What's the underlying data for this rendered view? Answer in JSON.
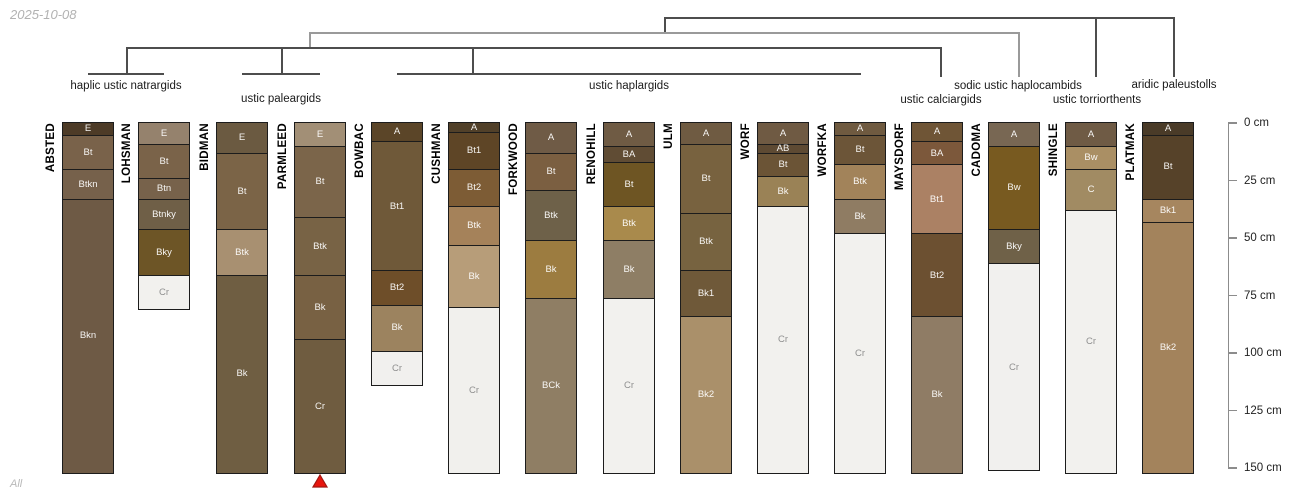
{
  "page": {
    "date_label": "2025-10-08",
    "footer_label": "All"
  },
  "chart_data": {
    "type": "bar",
    "subtype": "soil-profile-sketches-with-taxonomy-dendrogram",
    "title": "",
    "depth_axis": {
      "unit": "cm",
      "ticks": [
        0,
        25,
        50,
        75,
        100,
        125,
        150
      ],
      "tick_labels": [
        "0 cm",
        "25 cm",
        "50 cm",
        "75 cm",
        "100 cm",
        "125 cm",
        "150 cm"
      ],
      "range": [
        0,
        152
      ],
      "position": "right"
    },
    "taxa": [
      {
        "label": "haplic ustic natrargids",
        "members": [
          "ABSTED",
          "LOHSMAN"
        ],
        "x": 126,
        "y": 86
      },
      {
        "label": "ustic paleargids",
        "members": [
          "BIDMAN",
          "PARMLEED"
        ],
        "x": 281,
        "y": 99
      },
      {
        "label": "ustic haplargids",
        "members": [
          "BOWBAC",
          "CUSHMAN",
          "FORKWOOD",
          "RENOHILL",
          "ULM",
          "WORF",
          "WORFKA"
        ],
        "x": 629,
        "y": 86
      },
      {
        "label": "ustic calciargids",
        "members": [
          "MAYSDORF"
        ],
        "x": 941,
        "y": 100
      },
      {
        "label": "sodic ustic haplocambids",
        "members": [
          "CADOMA"
        ],
        "x": 1018,
        "y": 86
      },
      {
        "label": "ustic torriorthents",
        "members": [
          "SHINGLE"
        ],
        "x": 1097,
        "y": 100
      },
      {
        "label": "aridic paleustolls",
        "members": [
          "PLATMAK"
        ],
        "x": 1174,
        "y": 85
      }
    ],
    "dendrogram": {
      "levels": [
        {
          "y": 18,
          "x1": 665,
          "x2": 1174,
          "shade": "dark",
          "drops": [
            [
              665,
              33
            ],
            [
              1096,
              77
            ],
            [
              1174,
              77
            ]
          ]
        },
        {
          "y": 33,
          "x1": 310,
          "x2": 1019,
          "shade": "gray",
          "drops": [
            [
              310,
              48
            ],
            [
              1019,
              77
            ]
          ]
        },
        {
          "y": 48,
          "x1": 127,
          "x2": 941,
          "shade": "dark",
          "drops": [
            [
              127,
              74
            ],
            [
              282,
              74
            ],
            [
              473,
              74
            ],
            [
              941,
              77
            ]
          ]
        }
      ],
      "brackets": [
        [
          88,
          164,
          74
        ],
        [
          242,
          320,
          74
        ],
        [
          397,
          861,
          74
        ]
      ]
    },
    "profiles": [
      {
        "name": "ABSTED",
        "horizons": [
          {
            "name": "E",
            "top": 0,
            "bottom": 5,
            "color": "#4d3b27"
          },
          {
            "name": "Bt",
            "top": 5,
            "bottom": 20,
            "color": "#79624a"
          },
          {
            "name": "Btkn",
            "top": 20,
            "bottom": 33,
            "color": "#76614b"
          },
          {
            "name": "Bkn",
            "top": 33,
            "bottom": 152,
            "color": "#6e5a45"
          }
        ]
      },
      {
        "name": "LOHSMAN",
        "horizons": [
          {
            "name": "E",
            "top": 0,
            "bottom": 9,
            "color": "#95826d"
          },
          {
            "name": "Bt",
            "top": 9,
            "bottom": 24,
            "color": "#7a6349"
          },
          {
            "name": "Btn",
            "top": 24,
            "bottom": 33,
            "color": "#77624b"
          },
          {
            "name": "Btnky",
            "top": 33,
            "bottom": 46,
            "color": "#6f5f47"
          },
          {
            "name": "Bky",
            "top": 46,
            "bottom": 66,
            "color": "#6d5526"
          },
          {
            "name": "Cr",
            "top": 66,
            "bottom": 81,
            "color": "#f2f1ee"
          }
        ]
      },
      {
        "name": "BIDMAN",
        "horizons": [
          {
            "name": "E",
            "top": 0,
            "bottom": 13,
            "color": "#6b5a41"
          },
          {
            "name": "Bt",
            "top": 13,
            "bottom": 46,
            "color": "#7b6447"
          },
          {
            "name": "Btk",
            "top": 46,
            "bottom": 66,
            "color": "#a89071"
          },
          {
            "name": "Bk",
            "top": 66,
            "bottom": 152,
            "color": "#6f5e42"
          }
        ]
      },
      {
        "name": "PARMLEED",
        "horizons": [
          {
            "name": "E",
            "top": 0,
            "bottom": 10,
            "color": "#a28f76"
          },
          {
            "name": "Bt",
            "top": 10,
            "bottom": 41,
            "color": "#7b654a"
          },
          {
            "name": "Btk",
            "top": 41,
            "bottom": 66,
            "color": "#786345"
          },
          {
            "name": "Bk",
            "top": 66,
            "bottom": 94,
            "color": "#786143"
          },
          {
            "name": "Cr",
            "top": 94,
            "bottom": 152,
            "color": "#6f5c40"
          }
        ]
      },
      {
        "name": "BOWBAC",
        "horizons": [
          {
            "name": "A",
            "top": 0,
            "bottom": 8,
            "color": "#5b4528"
          },
          {
            "name": "Bt1",
            "top": 8,
            "bottom": 64,
            "color": "#6f5939"
          },
          {
            "name": "Bt2",
            "top": 64,
            "bottom": 79,
            "color": "#6e4e29"
          },
          {
            "name": "Bk",
            "top": 79,
            "bottom": 99,
            "color": "#9c835f"
          },
          {
            "name": "Cr",
            "top": 99,
            "bottom": 114,
            "color": "#f1f0ee"
          }
        ]
      },
      {
        "name": "CUSHMAN",
        "horizons": [
          {
            "name": "A",
            "top": 0,
            "bottom": 4,
            "color": "#514029"
          },
          {
            "name": "Bt1",
            "top": 4,
            "bottom": 20,
            "color": "#5e4526"
          },
          {
            "name": "Bt2",
            "top": 20,
            "bottom": 36,
            "color": "#7d5c35"
          },
          {
            "name": "Btk",
            "top": 36,
            "bottom": 53,
            "color": "#a5825a"
          },
          {
            "name": "Bk",
            "top": 53,
            "bottom": 80,
            "color": "#b79d79"
          },
          {
            "name": "Cr",
            "top": 80,
            "bottom": 152,
            "color": "#f1f0ed"
          }
        ]
      },
      {
        "name": "FORKWOOD",
        "horizons": [
          {
            "name": "A",
            "top": 0,
            "bottom": 13,
            "color": "#6f5b46"
          },
          {
            "name": "Bt",
            "top": 13,
            "bottom": 29,
            "color": "#7b5f41"
          },
          {
            "name": "Btk",
            "top": 29,
            "bottom": 51,
            "color": "#6e6149"
          },
          {
            "name": "Bk",
            "top": 51,
            "bottom": 76,
            "color": "#9c7c40"
          },
          {
            "name": "BCk",
            "top": 76,
            "bottom": 152,
            "color": "#8f7e64"
          }
        ]
      },
      {
        "name": "RENOHILL",
        "horizons": [
          {
            "name": "A",
            "top": 0,
            "bottom": 10,
            "color": "#6f5b44"
          },
          {
            "name": "BA",
            "top": 10,
            "bottom": 17,
            "color": "#604c34"
          },
          {
            "name": "Bt",
            "top": 17,
            "bottom": 36,
            "color": "#6e5523"
          },
          {
            "name": "Btk",
            "top": 36,
            "bottom": 51,
            "color": "#a98a4c"
          },
          {
            "name": "Bk",
            "top": 51,
            "bottom": 76,
            "color": "#8e7e65"
          },
          {
            "name": "Cr",
            "top": 76,
            "bottom": 152,
            "color": "#f2f1ee"
          }
        ]
      },
      {
        "name": "ULM",
        "horizons": [
          {
            "name": "A",
            "top": 0,
            "bottom": 9,
            "color": "#6f5b42"
          },
          {
            "name": "Bt",
            "top": 9,
            "bottom": 39,
            "color": "#78623f"
          },
          {
            "name": "Btk",
            "top": 39,
            "bottom": 64,
            "color": "#776340"
          },
          {
            "name": "Bk1",
            "top": 64,
            "bottom": 84,
            "color": "#6f5939"
          },
          {
            "name": "Bk2",
            "top": 84,
            "bottom": 152,
            "color": "#aa906a"
          }
        ]
      },
      {
        "name": "WORF",
        "horizons": [
          {
            "name": "A",
            "top": 0,
            "bottom": 9,
            "color": "#6f5a43"
          },
          {
            "name": "AB",
            "top": 9,
            "bottom": 13,
            "color": "#5e4a33"
          },
          {
            "name": "Bt",
            "top": 13,
            "bottom": 23,
            "color": "#6b5436"
          },
          {
            "name": "Bk",
            "top": 23,
            "bottom": 36,
            "color": "#9a8256"
          },
          {
            "name": "Cr",
            "top": 36,
            "bottom": 152,
            "color": "#f2f1ee"
          }
        ]
      },
      {
        "name": "WORFKA",
        "horizons": [
          {
            "name": "A",
            "top": 0,
            "bottom": 5,
            "color": "#6f5a40"
          },
          {
            "name": "Bt",
            "top": 5,
            "bottom": 18,
            "color": "#6c5538"
          },
          {
            "name": "Btk",
            "top": 18,
            "bottom": 33,
            "color": "#a2835a"
          },
          {
            "name": "Bk",
            "top": 33,
            "bottom": 48,
            "color": "#8f7c63"
          },
          {
            "name": "Cr",
            "top": 48,
            "bottom": 152,
            "color": "#f2f1ee"
          }
        ]
      },
      {
        "name": "MAYSDORF",
        "horizons": [
          {
            "name": "A",
            "top": 0,
            "bottom": 8,
            "color": "#6f5536"
          },
          {
            "name": "BA",
            "top": 8,
            "bottom": 18,
            "color": "#7c583b"
          },
          {
            "name": "Bt1",
            "top": 18,
            "bottom": 48,
            "color": "#ab8164"
          },
          {
            "name": "Bt2",
            "top": 48,
            "bottom": 84,
            "color": "#6c5031"
          },
          {
            "name": "Bk",
            "top": 84,
            "bottom": 152,
            "color": "#8f7c65"
          }
        ]
      },
      {
        "name": "CADOMA",
        "horizons": [
          {
            "name": "A",
            "top": 0,
            "bottom": 10,
            "color": "#786753"
          },
          {
            "name": "Bw",
            "top": 10,
            "bottom": 46,
            "color": "#785a20"
          },
          {
            "name": "Bky",
            "top": 46,
            "bottom": 61,
            "color": "#6f6148"
          },
          {
            "name": "Cr",
            "top": 61,
            "bottom": 151,
            "color": "#f1f0ee"
          }
        ]
      },
      {
        "name": "SHINGLE",
        "horizons": [
          {
            "name": "A",
            "top": 0,
            "bottom": 10,
            "color": "#6f5b45"
          },
          {
            "name": "Bw",
            "top": 10,
            "bottom": 20,
            "color": "#aa8f64"
          },
          {
            "name": "C",
            "top": 20,
            "bottom": 38,
            "color": "#a18b63"
          },
          {
            "name": "Cr",
            "top": 38,
            "bottom": 152,
            "color": "#f2f1ee"
          }
        ]
      },
      {
        "name": "PLATMAK",
        "horizons": [
          {
            "name": "A",
            "top": 0,
            "bottom": 5,
            "color": "#4a3b28"
          },
          {
            "name": "Bt",
            "top": 5,
            "bottom": 33,
            "color": "#564229"
          },
          {
            "name": "Bk1",
            "top": 33,
            "bottom": 43,
            "color": "#a6865f"
          },
          {
            "name": "Bk2",
            "top": 43,
            "bottom": 152,
            "color": "#a3835c"
          }
        ]
      }
    ],
    "marker": {
      "profile": "PARMLEED",
      "shape": "triangle-up",
      "fill": "#e8150d",
      "stroke": "#a11812"
    },
    "layout": {
      "depth0_y": 123,
      "px_per_cm": 2.3,
      "col_width": 52,
      "profile_x": [
        62,
        138,
        216,
        294,
        371,
        448,
        525,
        603,
        680,
        757,
        834,
        911,
        988,
        1065,
        1142
      ],
      "axis_x": 1228,
      "colors": {
        "tree_dark": "#4d4d4d",
        "tree_gray": "#9a9a9a",
        "boundary": "#1c1c1c",
        "light_text": "#8f8f8f",
        "axis_line": "#8c8c8c"
      }
    }
  }
}
